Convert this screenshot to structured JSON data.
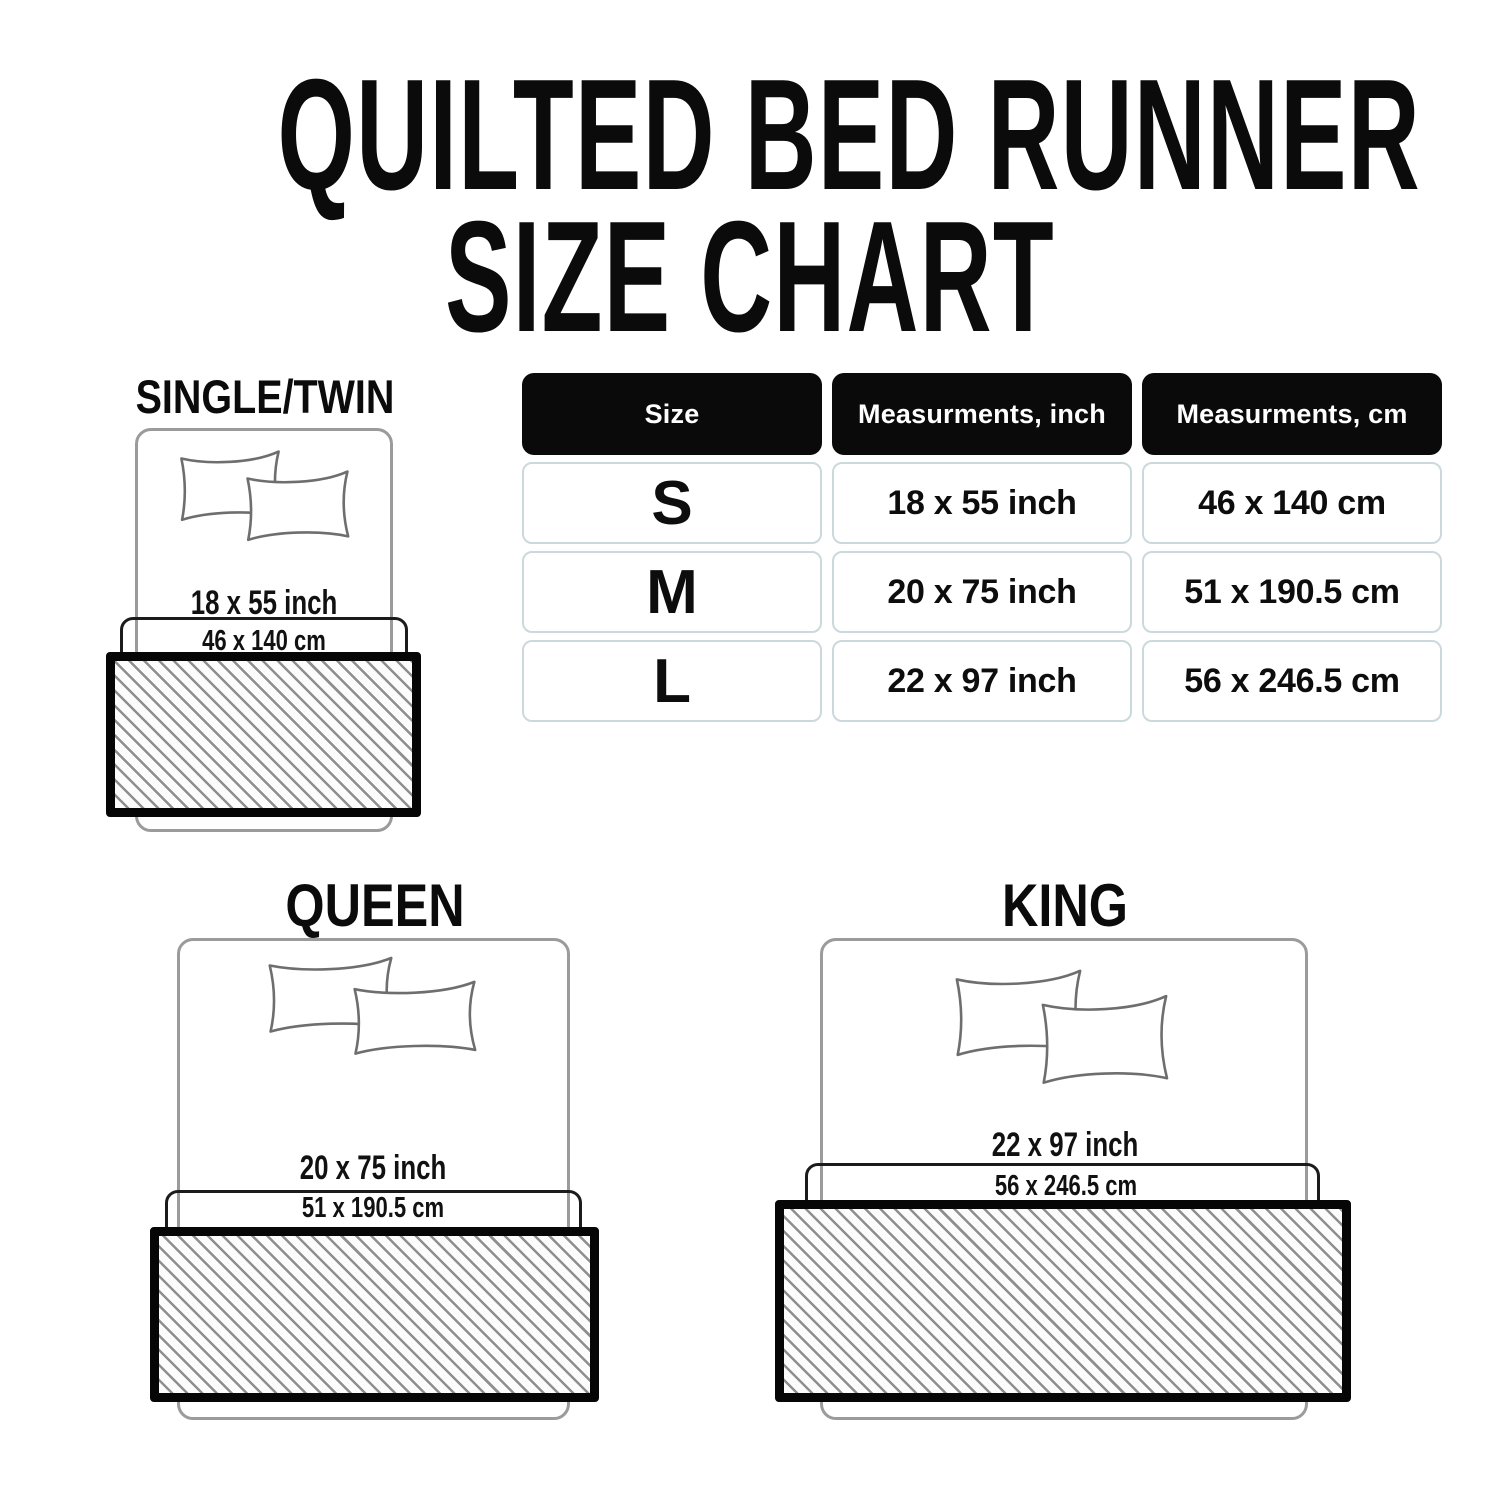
{
  "title": {
    "line1": "QUILTED BED RUNNER",
    "line2": "SIZE CHART"
  },
  "table": {
    "headers": [
      "Size",
      "Measurments, inch",
      "Measurments, cm"
    ],
    "rows": [
      {
        "size": "S",
        "inch": "18 x 55 inch",
        "cm": "46 x 140 cm"
      },
      {
        "size": "M",
        "inch": "20 x 75 inch",
        "cm": "51 x 190.5 cm"
      },
      {
        "size": "L",
        "inch": "22 x 97 inch",
        "cm": "56 x 246.5 cm"
      }
    ]
  },
  "diagrams": {
    "single": {
      "label": "SINGLE/TWIN",
      "inch": "18 x 55 inch",
      "cm": "46 x 140 cm"
    },
    "queen": {
      "label": "QUEEN",
      "inch": "20 x 75 inch",
      "cm": "51 x 190.5 cm"
    },
    "king": {
      "label": "KING",
      "inch": "22 x 97 inch",
      "cm": "56 x 246.5 cm"
    }
  },
  "colors": {
    "background": "#ffffff",
    "text": "#0d0d0d",
    "table_header_bg": "#0a0a0a",
    "table_header_text": "#ffffff",
    "table_cell_border": "#ccd9dc",
    "bed_outline": "#9b9b9b",
    "pillow_outline": "#6e6e6e",
    "cm_box_border": "#1b1b1b",
    "runner_border": "#060606",
    "hatch_line": "#8f8f8f"
  },
  "chart_data": {
    "type": "table",
    "title": "QUILTED BED RUNNER SIZE CHART",
    "columns": [
      "Size",
      "Measurments, inch",
      "Measurments, cm"
    ],
    "rows": [
      [
        "S",
        "18 x 55 inch",
        "46 x 140 cm"
      ],
      [
        "M",
        "20 x 75 inch",
        "51 x 190.5 cm"
      ],
      [
        "L",
        "22 x 97 inch",
        "56 x 246.5 cm"
      ]
    ]
  }
}
